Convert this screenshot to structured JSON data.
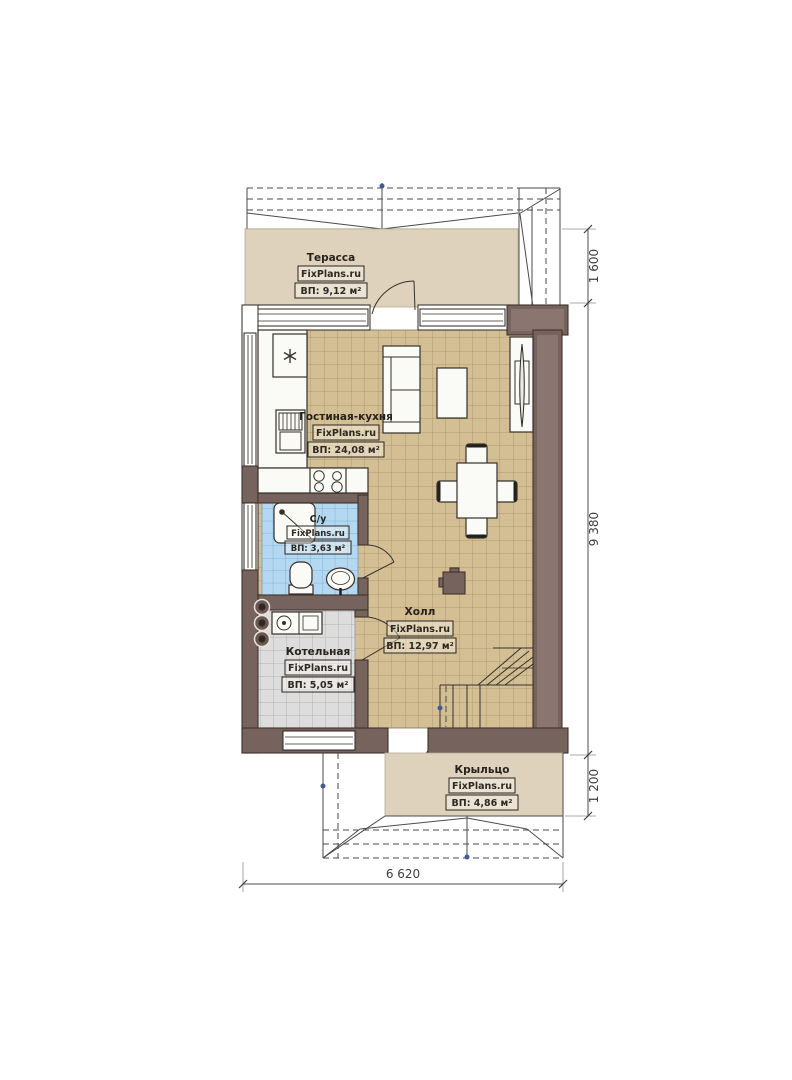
{
  "plan": {
    "brand_label": "FixPlans.ru",
    "rooms": [
      {
        "name": "Терасса",
        "area": "ВП: 9,12 м²"
      },
      {
        "name": "Гостиная-кухня",
        "area": "ВП: 24,08 м²"
      },
      {
        "name": "С/у",
        "area": "ВП: 3,63 м²"
      },
      {
        "name": "Котельная",
        "area": "ВП: 5,05 м²"
      },
      {
        "name": "Холл",
        "area": "ВП: 12,97 м²"
      },
      {
        "name": "Крыльцо",
        "area": "ВП: 4,86 м²"
      }
    ],
    "dimensions": {
      "terrace_depth": "1 600",
      "house_side": "9 380",
      "porch_depth": "1 200",
      "house_front": "6 620"
    },
    "colors": {
      "wall": "#77635e",
      "terrace_floor": "#ded2bc",
      "living_tile": "#d3bf93",
      "bath_tile": "#b4d8f1",
      "boiler_tile": "#dddddd"
    }
  }
}
